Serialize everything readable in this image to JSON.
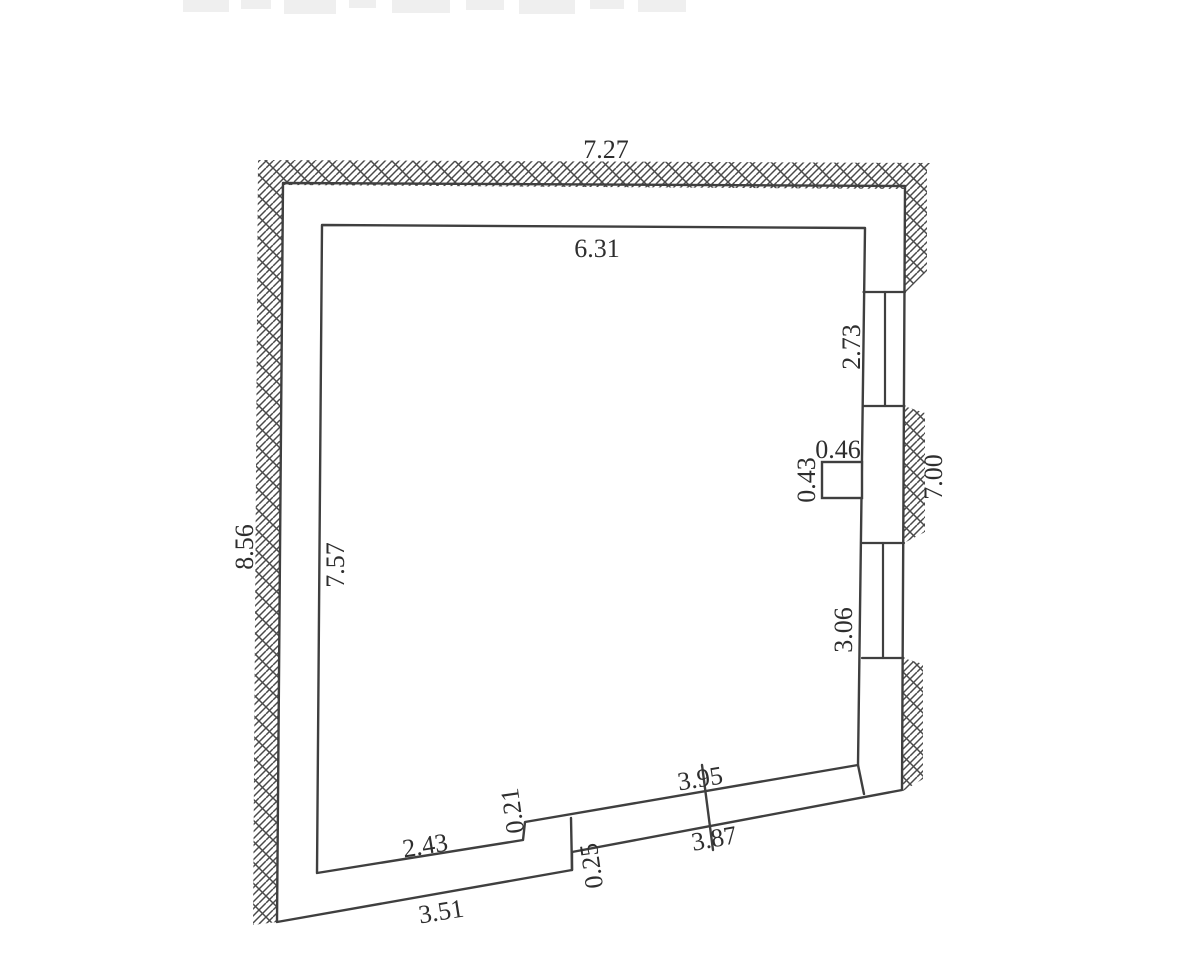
{
  "canvas": {
    "background": "#ffffff",
    "line_color": "#3f3f3f",
    "text_color": "#2e2e2e",
    "hatch_color": "#4a4a4a",
    "scan_artifact_color": "#efefef"
  },
  "floorplan": {
    "type": "room-plan-with-hatched-walls",
    "dimensions": {
      "top_outer": "7.27",
      "top_inner": "6.31",
      "left_outer": "8.56",
      "left_inner": "7.57",
      "right_outer": "7.00",
      "window_upper": "2.73",
      "window_lower": "3.06",
      "pier_width": "0.46",
      "pier_depth": "0.43",
      "bottom_inner_left": "2.43",
      "step_up": "0.21",
      "step_down": "0.25",
      "bottom_outer_left": "3.51",
      "bottom_inner_right": "3.95",
      "bottom_outer_right": "3.87"
    }
  }
}
